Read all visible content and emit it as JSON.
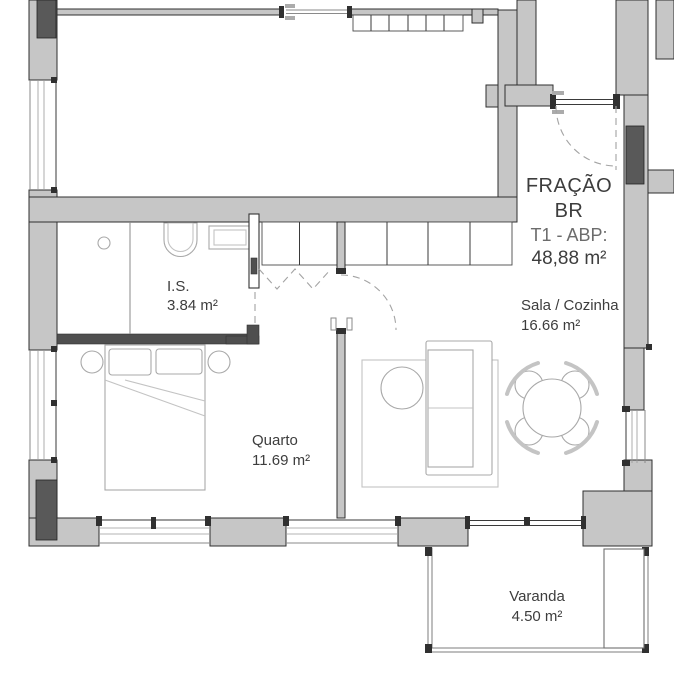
{
  "plan": {
    "fraction": {
      "line1": "FRAÇÃO",
      "line2": "BR",
      "line3": "T1 - ABP:",
      "line4": "48,88 m²"
    },
    "rooms": [
      {
        "id": "is",
        "name": "I.S.",
        "area": "3.84 m²"
      },
      {
        "id": "quarto",
        "name": "Quarto",
        "area": "11.69 m²"
      },
      {
        "id": "sala",
        "name": "Sala / Cozinha",
        "area": "16.66 m²"
      },
      {
        "id": "varanda",
        "name": "Varanda",
        "area": "4.50 m²"
      }
    ],
    "colors": {
      "wall": "#c6c6c6",
      "pillar": "#595959",
      "line": "#3a3a3a",
      "furniture": "#a8a8a8",
      "dashed": "#a3a3a3",
      "text": "#3d3d3d",
      "background": "#ffffff"
    }
  }
}
